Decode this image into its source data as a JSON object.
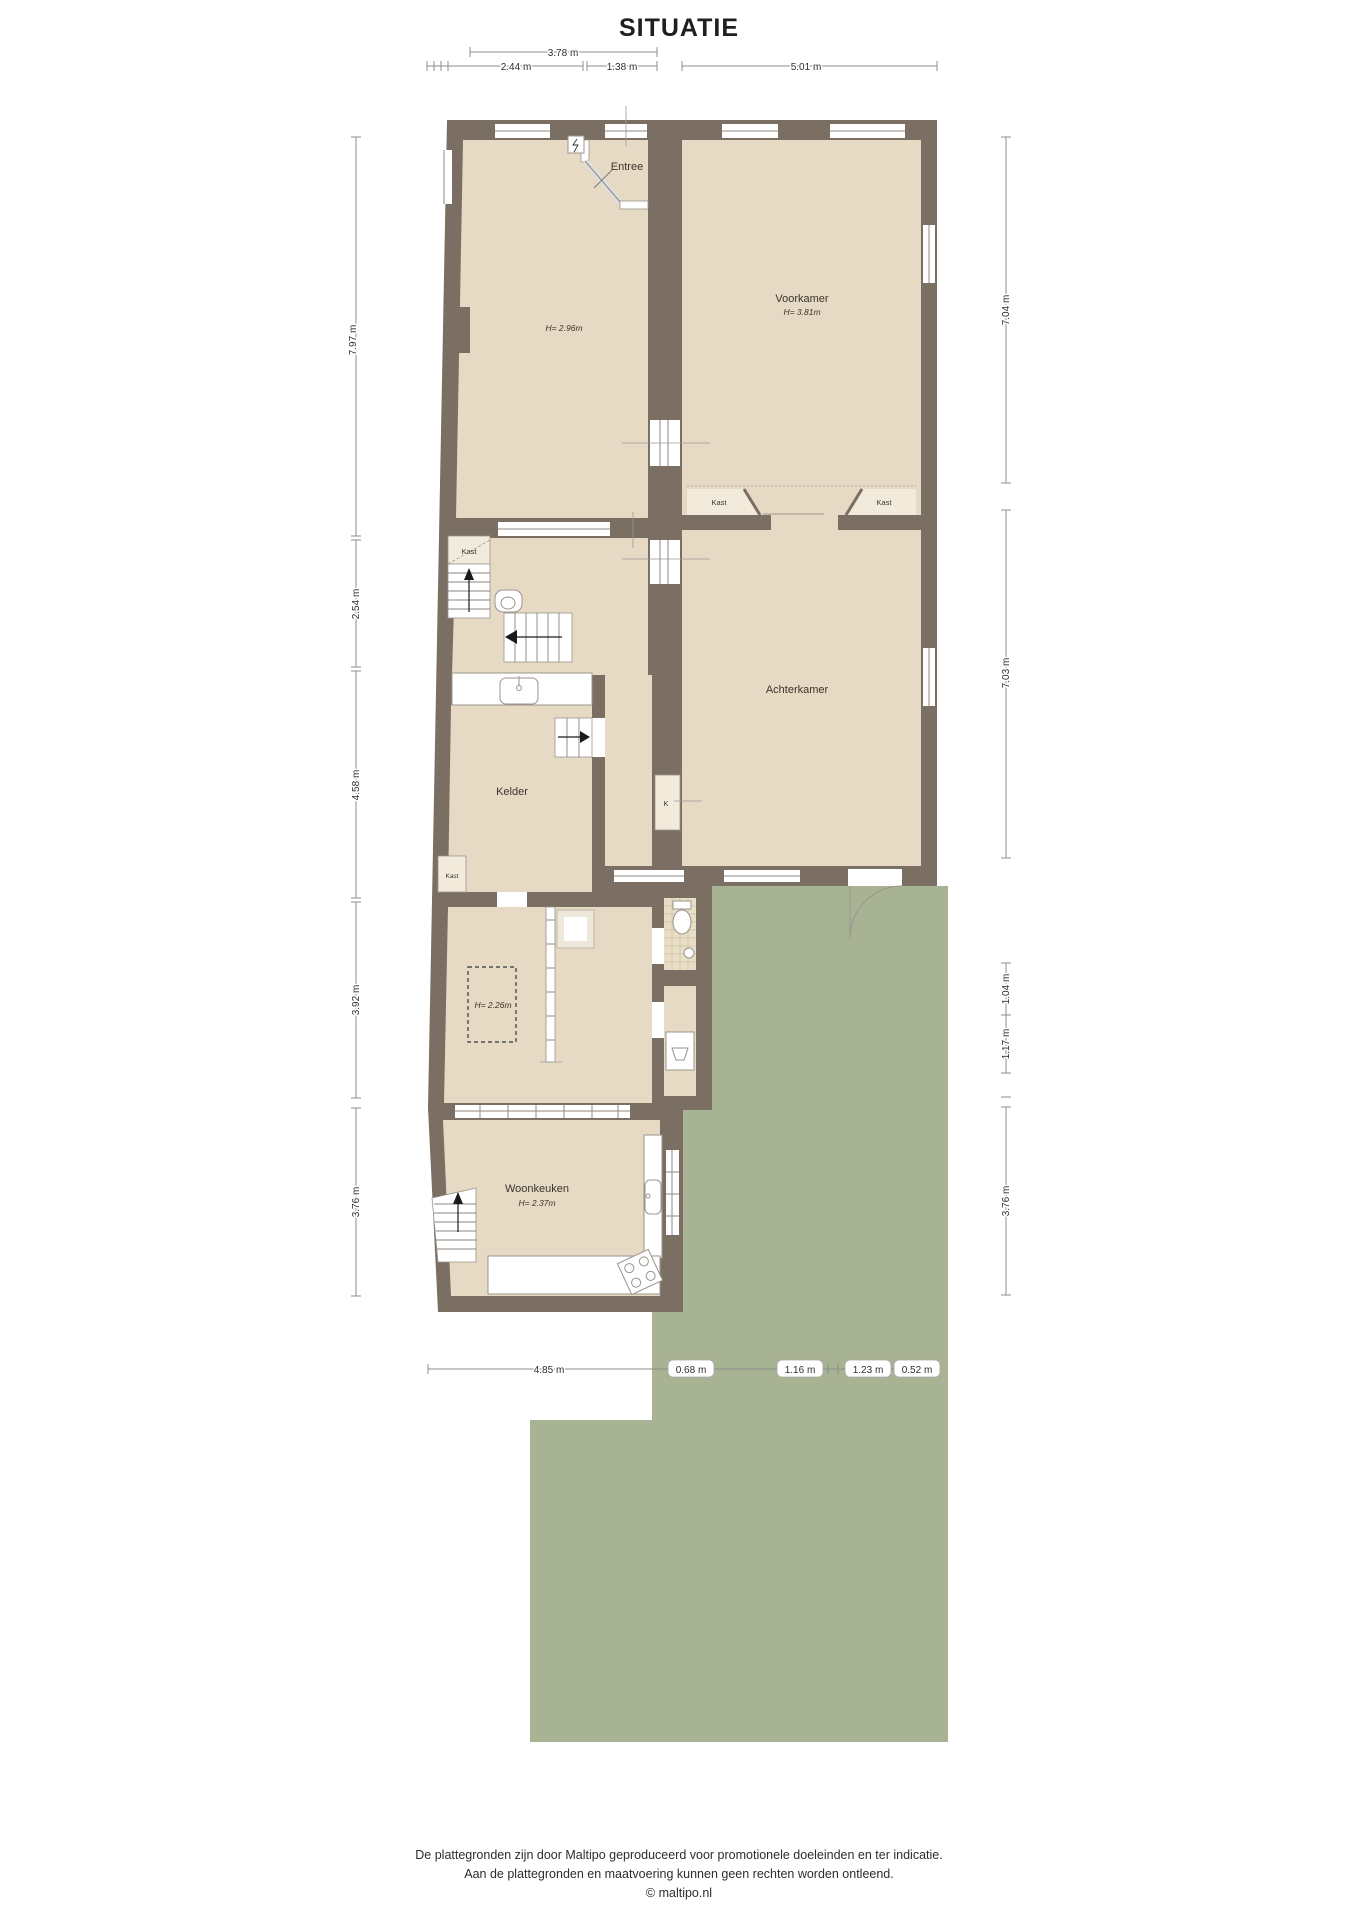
{
  "title": "SITUATIE",
  "rooms": {
    "entree": {
      "label": "Entree"
    },
    "voorkamer": {
      "label": "Voorkamer",
      "height": "H= 3.81m"
    },
    "livingroom": {
      "height": "H= 2.96m"
    },
    "achterkamer": {
      "label": "Achterkamer"
    },
    "kelder": {
      "label": "Kelder"
    },
    "cellar_room": {
      "height": "H= 2.26m"
    },
    "woonkeuken": {
      "label": "Woonkeuken",
      "height": "H= 2.37m"
    },
    "kast_suite_left": {
      "label": "Kast"
    },
    "kast_suite_right": {
      "label": "Kast"
    },
    "kast_hall": {
      "label": "Kast"
    },
    "kast_kelder": {
      "label": "Kast"
    },
    "shaft": {
      "label": "K"
    }
  },
  "dimensions": {
    "top": [
      {
        "label": "3.78 m"
      },
      {
        "label": "2.44 m"
      },
      {
        "label": "1.38 m"
      },
      {
        "label": "5.01 m"
      }
    ],
    "left": [
      {
        "label": "7.97 m"
      },
      {
        "label": "2.54 m"
      },
      {
        "label": "4.58 m"
      },
      {
        "label": "3.92 m"
      },
      {
        "label": "3.76 m"
      }
    ],
    "right": [
      {
        "label": "7.04 m"
      },
      {
        "label": "7.03 m"
      },
      {
        "label": "1.04 m"
      },
      {
        "label": "1.17 m"
      },
      {
        "label": "3.76 m"
      }
    ],
    "bottom": [
      {
        "label": "4.85 m"
      },
      {
        "label": "0.68 m"
      },
      {
        "label": "1.16 m"
      },
      {
        "label": "1.23 m"
      },
      {
        "label": "0.52 m"
      }
    ]
  },
  "footer": {
    "line1": "De plattegronden zijn door Maltipo geproduceerd voor promotionele doeleinden en ter indicatie.",
    "line2": "Aan de plattegronden en maatvoering kunnen geen rechten worden ontleend.",
    "line3": "© maltipo.nl"
  },
  "colors": {
    "wall": "#7b6e62",
    "floor": "#e7dac4",
    "closet": "#f2ebdb",
    "garden": "#a8b394",
    "tile": "#e9dfc6"
  }
}
